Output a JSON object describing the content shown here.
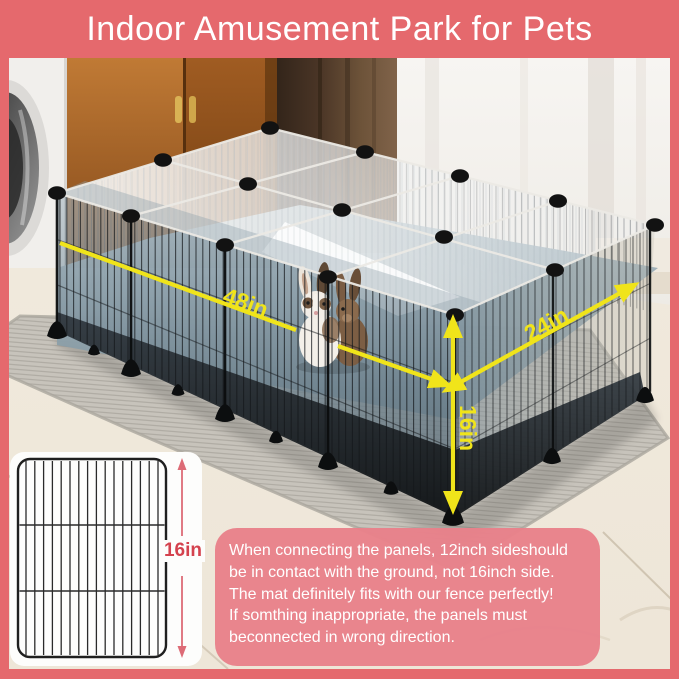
{
  "header": {
    "title": "Indoor Amusement Park for Pets"
  },
  "dimensions": {
    "length": "48in",
    "depth": "24in",
    "height": "16in"
  },
  "panel_card": {
    "height_label": "16in"
  },
  "note": {
    "lines": [
      "When connecting the panels, 12inch sideshould",
      "be in contact with the ground, not 16inch side.",
      "The mat definitely fits with our fence perfectly!",
      "If somthing inappropriate, the panels must",
      "beconnected in wrong direction."
    ]
  },
  "colors": {
    "banner_pink": "#e5696d",
    "note_box_pink": "#e8818a",
    "dimension_yellow": "#f0e41a",
    "panel_label_red": "#d4424e",
    "playpen_mat_blue": "#8b9ea9"
  }
}
